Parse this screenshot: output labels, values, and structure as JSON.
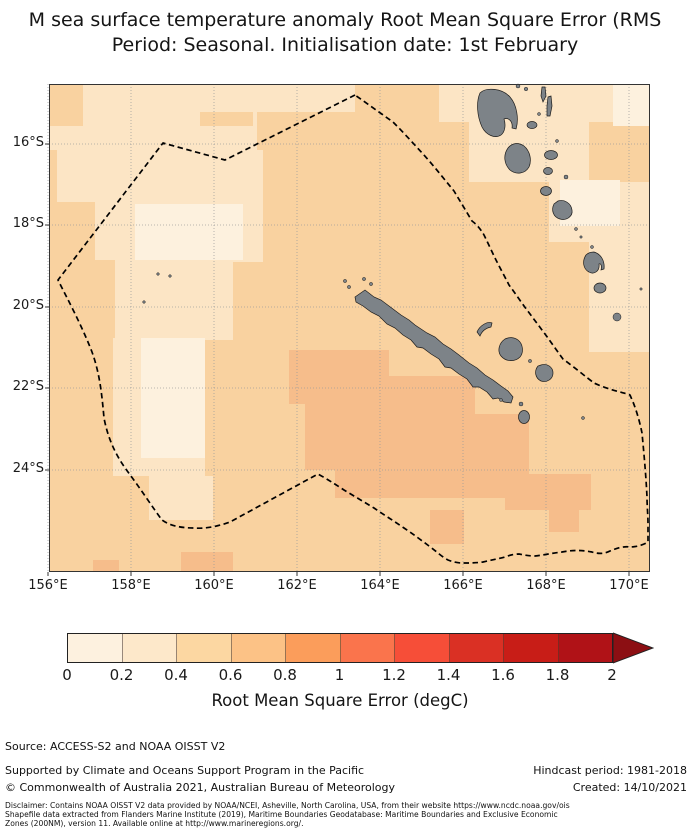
{
  "title": {
    "line1": "M sea surface temperature anomaly Root Mean Square Error (RMS",
    "line2": "Period: Seasonal. Initialisation date: 1st February"
  },
  "map": {
    "width": 601,
    "height": 488,
    "frame_color": "#333333",
    "grid_color": "#999999",
    "colors": {
      "base": "#f9d2a0",
      "light": "#fce5c5",
      "lightest": "#fdf1de",
      "dark": "#f6bd8b",
      "island_fill": "#7d8388",
      "island_stroke": "#1c1c1c",
      "boundary": "#000000"
    },
    "grid_x": [
      -1,
      82,
      165,
      248,
      331,
      414,
      497,
      580
    ],
    "grid_y": [
      60,
      141,
      223,
      304,
      386
    ],
    "x_tick_labels": [
      "156°E",
      "158°E",
      "160°E",
      "162°E",
      "164°E",
      "166°E",
      "168°E",
      "170°E"
    ],
    "y_tick_labels": [
      "16°S",
      "18°S",
      "20°S",
      "22°S",
      "24°S"
    ],
    "patches": [
      {
        "c": "light",
        "r": [
          0,
          0,
          208,
          66
        ]
      },
      {
        "c": "light",
        "r": [
          8,
          66,
          198,
          52
        ]
      },
      {
        "c": "light",
        "r": [
          46,
          118,
          148,
          58
        ]
      },
      {
        "c": "light",
        "r": [
          66,
          176,
          118,
          80
        ]
      },
      {
        "c": "light",
        "r": [
          64,
          254,
          92,
          138
        ]
      },
      {
        "c": "light",
        "r": [
          100,
          392,
          64,
          44
        ]
      },
      {
        "c": "light",
        "r": [
          206,
          0,
          100,
          28
        ]
      },
      {
        "c": "light",
        "r": [
          156,
          66,
          58,
          112
        ]
      },
      {
        "c": "light",
        "r": [
          390,
          0,
          211,
          38
        ]
      },
      {
        "c": "light",
        "r": [
          420,
          38,
          120,
          60
        ]
      },
      {
        "c": "light",
        "r": [
          500,
          98,
          101,
          60
        ]
      },
      {
        "c": "light",
        "r": [
          540,
          158,
          61,
          110
        ]
      },
      {
        "c": "base",
        "r": [
          0,
          0,
          34,
          42
        ]
      },
      {
        "c": "base",
        "r": [
          151,
          28,
          53,
          14
        ]
      },
      {
        "c": "lightest",
        "r": [
          86,
          120,
          108,
          56
        ]
      },
      {
        "c": "lightest",
        "r": [
          92,
          254,
          64,
          120
        ]
      },
      {
        "c": "lightest",
        "r": [
          564,
          0,
          37,
          42
        ]
      },
      {
        "c": "lightest",
        "r": [
          511,
          96,
          60,
          46
        ]
      },
      {
        "c": "dark",
        "r": [
          240,
          266,
          100,
          54
        ]
      },
      {
        "c": "dark",
        "r": [
          256,
          320,
          160,
          66
        ]
      },
      {
        "c": "dark",
        "r": [
          286,
          386,
          190,
          28
        ]
      },
      {
        "c": "dark",
        "r": [
          336,
          292,
          90,
          94
        ]
      },
      {
        "c": "dark",
        "r": [
          400,
          330,
          80,
          60
        ]
      },
      {
        "c": "dark",
        "r": [
          456,
          390,
          86,
          36
        ]
      },
      {
        "c": "dark",
        "r": [
          381,
          426,
          34,
          34
        ]
      },
      {
        "c": "dark",
        "r": [
          500,
          426,
          30,
          22
        ]
      },
      {
        "c": "dark",
        "r": [
          132,
          468,
          52,
          20
        ]
      },
      {
        "c": "dark",
        "r": [
          44,
          476,
          26,
          12
        ]
      }
    ],
    "eez_path": "M306,11 L176,76 L114,59 L9,196 C19,216 33,242 43,268 C51,290 53,312 55,334 C59,355 67,372 79,388 C91,404 104,424 113,436 C121,442 133,444 145,444 C157,445 170,442 181,438 L269,390 C278,395 286,400 295,406 C305,412 315,418 325,424 C335,431 345,437 355,444 C364,450 372,456 380,462 C387,467 393,473 399,476 C404,478 409,479 413,479 C420,479 427,479 434,478 C442,476 449,475 456,473 C461,471 466,470 470,470 C475,471 480,472 486,472 C495,471 504,469 513,468 C523,466 533,466 543,468 C549,470 555,470 561,467 C568,464 575,462 581,463 C587,463 594,461 599,458 C599,453 599,448 599,440 C599,431 598,422 598,413 C597,392 595,370 593,349 C591,339 588,328 584,318 L581,311 C573,308 560,306 545,299 C537,293 525,283 514,275 C508,267 502,258 496,250 C490,242 484,234 478,226 C472,218 466,209 460,201 C456,193 451,184 447,176 C443,168 439,159 435,151 C431,144 427,140 423,137 C417,127 411,117 405,107 C395,95 385,82 374,70 C364,59 354,48 344,38 Z",
    "islands": [
      {
        "name": "new-caledonia",
        "path": "M306,213 L316,206 L325,213 L332,216 L340,222 L352,231 L360,236 L366,241 L378,249 L386,253 L394,260 L402,265 L410,271 L420,279 L428,284 L436,291 L444,296 L452,302 L459,307 L464,313 L462,319 L455,318 L449,314 L444,315 L438,308 L430,303 L424,303 L418,295 L410,290 L402,284 L396,283 L390,275 L382,270 L374,264 L368,263 L362,256 L354,251 L346,244 L338,240 L330,232 L322,228 L314,222 L307,218 Z"
      },
      {
        "name": "espiritu-santo",
        "path": "M431,9 C427,18 428,32 433,43 C437,51 446,55 452,51 C456,48 457,41 455,35 C460,33 464,38 463,44 L467,45 C470,35 468,21 461,13 C453,4 437,3 431,9 Z"
      },
      {
        "name": "malakula",
        "path": "M459,64 C454,71 455,80 461,86 C467,91 476,90 480,83 C483,76 481,67 475,62 C469,58 463,59 459,64 Z"
      },
      {
        "name": "pentecost",
        "path": "M499,13 L502,12 L503,22 L501,32 L498,32 L498,22 Z"
      },
      {
        "name": "maewo",
        "path": "M493,3 L496,3 L497,12 L494,18 L492,12 Z"
      },
      {
        "name": "erromango",
        "path": "M505,120 C502,126 504,133 511,135 C518,137 524,132 523,126 C522,119 515,115 509,117 Z"
      },
      {
        "name": "tanna",
        "path": "M537,171 C533,177 534,185 540,188 C545,191 551,187 550,180 C552,179 553,182 552,186 L555,185 C556,177 552,170 545,168 C542,168 539,169 537,171 Z"
      },
      {
        "name": "ouvea",
        "path": "M428,248 C431,241 439,237 443,239 L442,243 C437,244 433,247 431,252 Z"
      },
      {
        "name": "lifou",
        "path": "M456,255 C450,259 448,267 452,272 C457,278 466,278 471,273 C475,268 474,260 469,256 C465,253 460,253 456,255 Z"
      },
      {
        "name": "mare",
        "path": "M489,282 C485,287 486,294 492,297 C498,299 504,295 504,289 C504,283 498,279 492,281 Z"
      }
    ],
    "ellipses": [
      [
        475,
        333,
        5.5,
        6.5
      ],
      [
        483,
        41,
        5,
        3.5
      ],
      [
        502,
        71,
        6.5,
        4.5
      ],
      [
        499,
        87,
        4.5,
        3.5
      ],
      [
        497,
        107,
        5.5,
        4.5
      ],
      [
        551,
        204,
        6,
        5
      ]
    ],
    "specks": [
      [
        490,
        30,
        1.5
      ],
      [
        508,
        57,
        1.5
      ],
      [
        517,
        93,
        2
      ],
      [
        527,
        145,
        1.5
      ],
      [
        532,
        153,
        1.2
      ],
      [
        543,
        163,
        1.5
      ],
      [
        568,
        233,
        4
      ],
      [
        481,
        277,
        1.6
      ],
      [
        534,
        334,
        1.5
      ],
      [
        109,
        190,
        1.3
      ],
      [
        121,
        192,
        1.3
      ],
      [
        95,
        218,
        1.3
      ],
      [
        315,
        195,
        1.6
      ],
      [
        322,
        200,
        1.6
      ],
      [
        296,
        197,
        1.6
      ],
      [
        300,
        203,
        1.6
      ],
      [
        469,
        2,
        2
      ],
      [
        477,
        5,
        1.8
      ],
      [
        452,
        316,
        1.5
      ],
      [
        472,
        320,
        2
      ],
      [
        592,
        205,
        1.2
      ]
    ]
  },
  "colorbar": {
    "segments": [
      "#fdf1df",
      "#fde8ca",
      "#fcd7a2",
      "#fcc286",
      "#fb9d5b",
      "#fa744c",
      "#f64e38",
      "#da3024",
      "#c81d17",
      "#b01217"
    ],
    "arrow_color": "#8c0f13",
    "tick_labels": [
      "0",
      "0.2",
      "0.4",
      "0.6",
      "0.8",
      "1",
      "1.2",
      "1.4",
      "1.6",
      "1.8",
      "2"
    ],
    "tick_values": [
      0,
      0.2,
      0.4,
      0.6,
      0.8,
      1.0,
      1.2,
      1.4,
      1.6,
      1.8,
      2.0
    ],
    "label": "Root Mean Square Error (degC)"
  },
  "source_line": "Source: ACCESS-S2 and NOAA OISST V2",
  "footer": {
    "left1": "Supported by Climate and Oceans Support Program in the Pacific",
    "left2": "© Commonwealth of Australia 2021, Australian Bureau of Meteorology",
    "right1": "Hindcast period: 1981-2018",
    "right2": "Created: 14/10/2021"
  },
  "disclaimer": {
    "line1": "Disclaimer: Contains NOAA OISST V2 data provided by NOAA/NCEI, Asheville, North Carolina, USA, from their website https://www.ncdc.noaa.gov/ois",
    "line2": "Shapefile data extracted from Flanders Marine Institute (2019), Maritime Boundaries Geodatabase: Maritime Boundaries and Exclusive Economic",
    "line3": "Zones (200NM), version 11. Available online at http://www.marineregions.org/."
  }
}
